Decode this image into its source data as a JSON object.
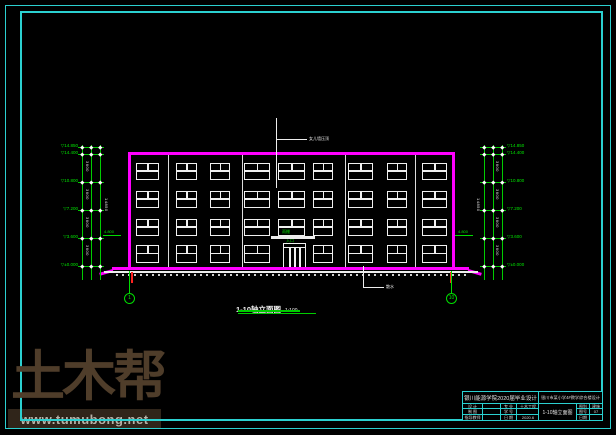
{
  "colors": {
    "frame_cyan": "#2bd0d0",
    "building_magenta": "#ff00ff",
    "cad_green": "#00dd00",
    "cad_white": "#ededed",
    "cad_red": "#ff2222",
    "watermark_brown": "#4f3d2a",
    "watermark_bar_bg": "#30251a",
    "watermark_bar_text": "#b8b2a8"
  },
  "watermark": {
    "logo": "土木帮",
    "url": "www.tumubong.net"
  },
  "caption": {
    "text": "1-10轴立面图",
    "scale": "1:100"
  },
  "annotations": {
    "roof_leader": "女儿墙压顶",
    "ground_leader": "散水",
    "canopy_label": "雨棚",
    "entrance_label": "入口",
    "side_level_left": "4.800",
    "side_level_right": "4.800",
    "axis_left": "1",
    "axis_right": "10"
  },
  "levels": {
    "values": [
      "14.850",
      "14.400",
      "10.800",
      "7.200",
      "3.600",
      "±0.000"
    ],
    "floor_dim": "3600",
    "total_dim": "14850"
  },
  "elevation": {
    "floors": 4,
    "bays": 9,
    "window_cols_x": [
      136,
      176,
      210,
      244,
      278,
      313,
      348,
      387,
      422
    ],
    "window_widths": [
      23,
      21,
      20,
      26,
      27,
      20,
      25,
      20,
      25
    ],
    "window_rows_y": [
      163,
      191,
      219,
      245
    ],
    "window_height": 17,
    "ground_floor_window_height": 18,
    "entrance_bay": 4,
    "pipes_x": [
      168,
      242,
      345,
      415
    ]
  },
  "titleblock": {
    "school": "银川能源学院2020届毕业设计",
    "project": "银川市某小学4#教学综合楼设计",
    "rows": [
      {
        "l1": "设 计",
        "v1": "",
        "l2": "专 业",
        "v2": "土木工程"
      },
      {
        "l1": "制 图",
        "v1": "",
        "l2": "学 号",
        "v2": ""
      },
      {
        "l1": "指导教师",
        "v1": "",
        "l2": "日 期",
        "v2": "2020.6"
      }
    ],
    "drawing_title": "1-10轴立面图",
    "right_rows": [
      {
        "label": "图别",
        "value": "建施"
      },
      {
        "label": "图号",
        "value": "07"
      },
      {
        "label": "日期",
        "value": ""
      }
    ]
  }
}
